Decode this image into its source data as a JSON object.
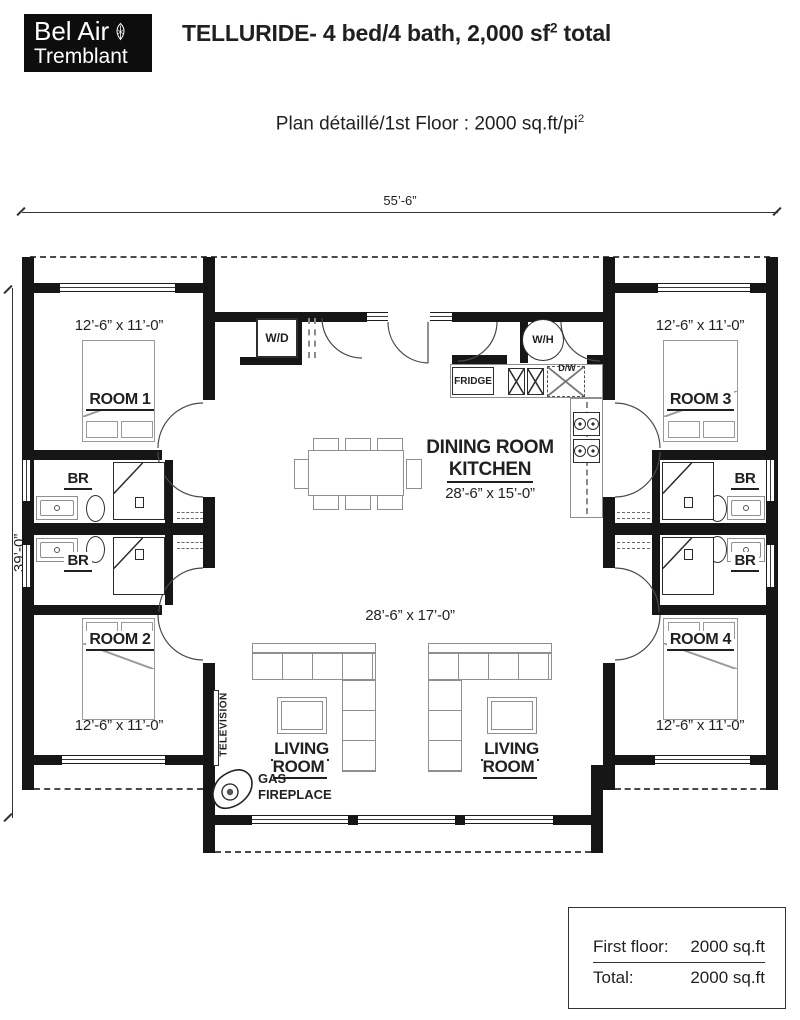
{
  "header": {
    "logo_line1": "Bel Air",
    "logo_line2": "Tremblant",
    "title_prefix": "TELLURIDE- 4 bed/4 bath, 2,000 sf",
    "title_sup": "2",
    "title_suffix": " total",
    "subtitle_prefix": "Plan détaillé/1st Floor : 2000 sq.ft/pi",
    "subtitle_sup": "2"
  },
  "plan": {
    "overall_width": "55’-6”",
    "overall_depth": "39’-0”",
    "rooms": [
      {
        "name": "ROOM 1",
        "dims": "12’-6” x 11’-0”"
      },
      {
        "name": "ROOM 2",
        "dims": "12’-6” x 11’-0”"
      },
      {
        "name": "ROOM 3",
        "dims": "12’-6” x 11’-0”"
      },
      {
        "name": "ROOM 4",
        "dims": "12’-6” x 11’-0”"
      }
    ],
    "bath_label": "BR",
    "dining": {
      "line1": "DINING ROOM",
      "line2": "KITCHEN",
      "dims": "28’-6” x 15’-0”"
    },
    "living": {
      "label": "LIVING ROOM",
      "dims": "28’-6” x 17’-0”"
    },
    "fixtures": {
      "washer_dryer": "W/D",
      "water_heater": "W/H",
      "fridge": "FRIDGE",
      "dishwasher": "D/W",
      "television": "TELEVISION",
      "fireplace_line1": "GAS",
      "fireplace_line2": "FIREPLACE"
    }
  },
  "summary": {
    "rows": [
      {
        "label": "First floor:",
        "value": "2000 sq.ft"
      },
      {
        "label": "Total:",
        "value": "2000 sq.ft"
      }
    ]
  },
  "colors": {
    "wall": "#161616",
    "text": "#231f20",
    "furniture_line": "#8f8f8f"
  }
}
